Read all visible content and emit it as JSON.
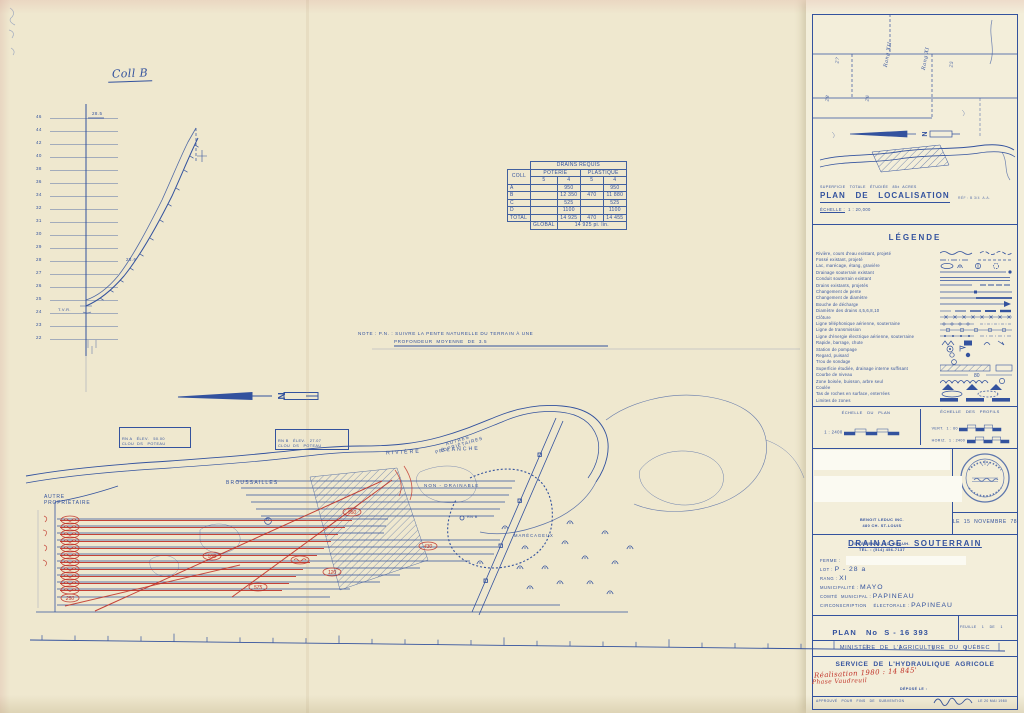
{
  "colors": {
    "ink": "#33529e",
    "ink_light": "#6d82b6",
    "red": "#c03026",
    "paper": "#efe8cf",
    "paper_right": "#f3eeda"
  },
  "profile": {
    "title": "Coll B",
    "top_label": "28.5",
    "mid_label": "28.6",
    "tvr_label": "T.V.R.",
    "axis_labels": [
      "46",
      "44",
      "42",
      "40",
      "38",
      "36",
      "34",
      "32",
      "31",
      "30",
      "29",
      "28",
      "27",
      "26",
      "25",
      "24",
      "23",
      "22"
    ]
  },
  "drains_table": {
    "title": "DRAINS    REQUIS",
    "col_label": "COLL",
    "group1": "POTERIE",
    "group2": "PLASTIQUE",
    "sub_cols": [
      "5",
      "4",
      "5",
      "4"
    ],
    "rows": [
      {
        "coll": "A",
        "c": [
          "",
          "950",
          "",
          "950"
        ]
      },
      {
        "coll": "B",
        "c": [
          "",
          "12 350",
          "470",
          "11 880"
        ]
      },
      {
        "coll": "C",
        "c": [
          "",
          "525",
          "",
          "525"
        ]
      },
      {
        "coll": "D",
        "c": [
          "",
          "1100",
          "",
          "1100"
        ]
      }
    ],
    "total_label": "TOTAL",
    "total": [
      "",
      "14 925",
      "470",
      "14 455"
    ],
    "global_label": "GLOBAL",
    "global_value": "14 925   pi. lin."
  },
  "note": {
    "line1": "NOTE : P.N. : SUIVRE LA PENTE NATURELLE DU TERRAIN À UNE",
    "line2": "PROFONDEUR  MOYENNE  DE  3.5"
  },
  "map": {
    "autre1": "AUTRE",
    "autre2": "PROPRIÉTAIRE",
    "broussailles": "BROUSSAILLES",
    "riviere": "RIVIÈRE      BLANCHE",
    "rna1": "RN A   ÉLEV.   50.00",
    "rna2": "CLOU  DS   POTEAU",
    "rnb1": "RN B   ÉLEV.   27.07",
    "rnb2": "CLOU  DS   POTEAU",
    "autres1": "AUTRES",
    "autres2": "PROPRIÉTAIRES",
    "non_drainable": "NON - DRAINABLE",
    "rnb": "RN B",
    "marecageux": "MARÉCAGEUX",
    "coll_d": "D",
    "red_values": [
      "530",
      "575",
      "120",
      "430",
      "950",
      "250"
    ]
  },
  "location": {
    "superficie": "SUPERFICIE   TOTALE   ÉTUDIÉE   85±  ACRES",
    "title": "PLAN   DE   LOCALISATION",
    "ref": "RÉF : B 3/4  A.A.",
    "echelle_label": "ÉCHELLE :",
    "echelle_value": "1 : 20,000",
    "rang1": "Rang XII",
    "rang2": "Rang XI",
    "lot1": "25",
    "lot2": "26",
    "lot3": "27",
    "lot4": "28"
  },
  "legend": {
    "title": "LÉGENDE",
    "items": [
      {
        "label": "Rivière, cours d'eau existant, projeté",
        "sym": "river"
      },
      {
        "label": "Fossé existant, projeté",
        "sym": "fosse"
      },
      {
        "label": "Lac, marécage, étang, gravière",
        "sym": "lake"
      },
      {
        "label": "Drainage souterrain existant",
        "sym": "drainexist"
      },
      {
        "label": "Conduit souterrain existant",
        "sym": "conduit"
      },
      {
        "label": "Drains existants, projetés",
        "sym": "drains"
      },
      {
        "label": "Changement de pente",
        "sym": "pente"
      },
      {
        "label": "Changement de diamètre",
        "sym": "diam"
      },
      {
        "label": "Bouche de décharge",
        "sym": "bouche"
      },
      {
        "label": "Diamètre des drains  4,5,6,8,10",
        "sym": "sizes"
      },
      {
        "label": "Clôture",
        "sym": "cloture"
      },
      {
        "label": "Ligne téléphonique aérienne, souterraine",
        "sym": "tele"
      },
      {
        "label": "Ligne de transmission",
        "sym": "transmission"
      },
      {
        "label": "Ligne d'énergie électrique aérienne, souterraine",
        "sym": "energie"
      },
      {
        "label": "Rapide, barrage, chute",
        "sym": "rapide"
      },
      {
        "label": "Station de pompage",
        "sym": "pompage"
      },
      {
        "label": "Regard, puisard",
        "sym": "regard"
      },
      {
        "label": "Trou de sondage",
        "sym": "sondage"
      },
      {
        "label": "Superficie étudiée, drainage interne suffisant",
        "sym": "etudiee"
      },
      {
        "label": "Courbe de niveau",
        "sym": "courbe"
      },
      {
        "label": "Zone boisée, buisson, arbre seul",
        "sym": "boisee"
      },
      {
        "label": "Coulée",
        "sym": "coulee"
      },
      {
        "label": "Tas de roches en surface, enterrées",
        "sym": "roches"
      },
      {
        "label": "Limites de zones",
        "sym": "zones"
      }
    ]
  },
  "scales": {
    "plan_label": "ÉCHELLE   DU   PLAN",
    "plan_ratio": "1 : 2400",
    "plan_units": "pi",
    "profils_label": "ÉCHELLE   DES   PROFILS",
    "vert_label": "VERT.",
    "vert_ratio": "1 : 60",
    "horiz_label": "HORIZ.",
    "horiz_ratio": "1 : 2400"
  },
  "firm": {
    "name": "BENOIT LEDUC INC.",
    "addr1": "480 CH. ST-LOUIS",
    "addr2": "ST-ÉTIENNE, CO. BEAUH.",
    "tel": "TÉL. : (514) 456-7137",
    "date": "LE  15  NOVEMBRE  78"
  },
  "title_block": {
    "title": "DRAINAGE   SOUTERRAIN",
    "ferme_label": "FERME :",
    "lot_label": "LOT :",
    "lot": "P - 28 a",
    "rang_label": "RANG :",
    "rang": "XI",
    "mun_label": "MUNICIPALITÉ :",
    "mun": "MAYO",
    "comte_label": "COMTÉ  MUNICIPAL :",
    "comte": "PAPINEAU",
    "circ_label": "CIRCONSCRIPTION    ÉLECTORALE :",
    "circ": "PAPINEAU",
    "plan_label": "PLAN   No",
    "plan_no": "S - 16 393",
    "feuille": "FEUILLE    1    DE    1"
  },
  "footer": {
    "ministere": "MINISTÈRE  DE  L'AGRICULTURE  DU  QUÉBEC",
    "service": "SERVICE  DE  L'HYDRAULIQUE  AGRICOLE",
    "red1": "Réalisation 1980 : 14 845'",
    "red2": "Phase Vaudreuil",
    "depose": "DÉPOSÉ LE :",
    "approuve": "APPROUVÉ   POUR   FINS   DE   SUBVENTION",
    "date": "LE 20 MAI 1980"
  }
}
